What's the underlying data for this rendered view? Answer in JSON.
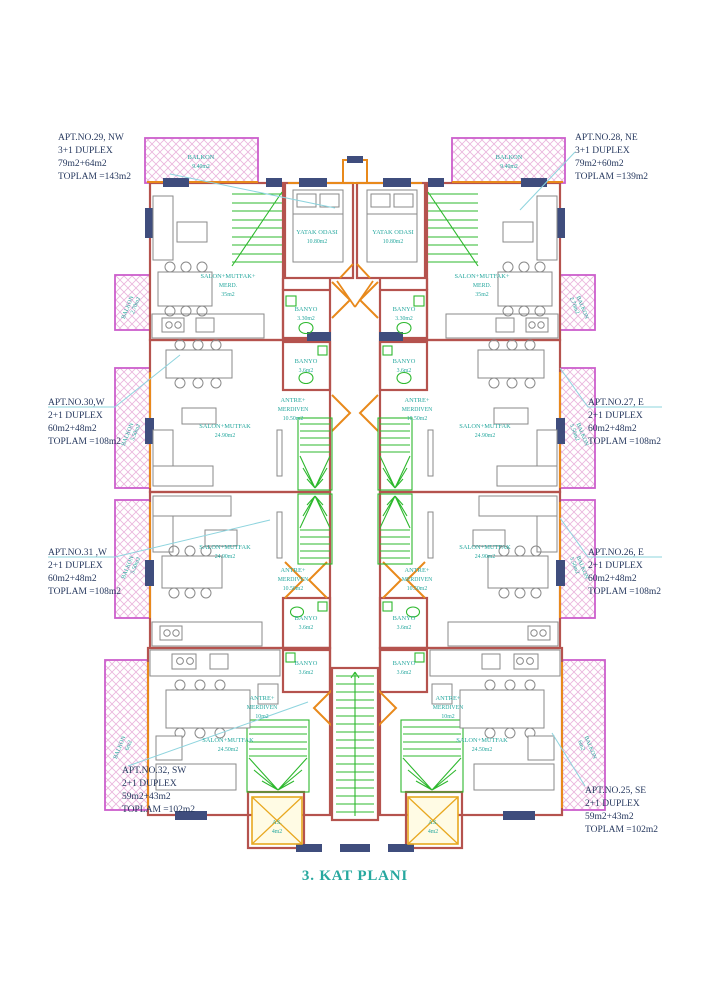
{
  "title": "3. KAT PLANI",
  "colors": {
    "wall": "#b5534e",
    "orange": "#e8891b",
    "navy": "#3f4d7d",
    "magenta": "#cc5ecc",
    "green": "#2db82d",
    "teal": "#27a89f",
    "callout_text": "#27395f",
    "leader": "#8ed4de",
    "elevator_yellow": "#e8a820",
    "furniture_gray": "#8a8a8a"
  },
  "apartments": [
    {
      "id": "apt29",
      "lines": [
        "APT.NO.29, NW",
        "3+1 DUPLEX",
        "79m2+64m2",
        "TOPLAM =143m2"
      ]
    },
    {
      "id": "apt28",
      "lines": [
        "APT.NO.28, NE",
        "3+1 DUPLEX",
        "79m2+60m2",
        "TOPLAM =139m2"
      ]
    },
    {
      "id": "apt30",
      "lines": [
        "APT.NO.30,W",
        "2+1 DUPLEX",
        "60m2+48m2",
        "TOPLAM =108m2"
      ]
    },
    {
      "id": "apt27",
      "lines": [
        "APT.NO.27, E",
        "2+1 DUPLEX",
        "60m2+48m2",
        "TOPLAM =108m2"
      ]
    },
    {
      "id": "apt31",
      "lines": [
        "APT.NO.31 ,W",
        "2+1 DUPLEX",
        "60m2+48m2",
        "TOPLAM =108m2"
      ]
    },
    {
      "id": "apt26",
      "lines": [
        "APT.NO.26, E",
        "2+1 DUPLEX",
        "60m2+48m2",
        "TOPLAM =108m2"
      ]
    },
    {
      "id": "apt32",
      "lines": [
        "APT.NO.32, SW",
        "2+1 DUPLEX",
        "59m2+43m2",
        "TOPLAM =102m2"
      ]
    },
    {
      "id": "apt25",
      "lines": [
        "APT.NO.25, SE",
        "2+1 DUPLEX",
        "59m2+43m2",
        "TOPLAM =102m2"
      ]
    }
  ],
  "rooms": {
    "yatak": {
      "name": "YATAK ODASI",
      "area": "10.80m2"
    },
    "salon_top": {
      "l1": "SALON+MUTFAK+",
      "l2": "MERD.",
      "l3": "35m2"
    },
    "balkon_top": {
      "name": "BALKON",
      "area": "9.40m2"
    },
    "balkon_small": {
      "name": "BALKON",
      "area": "2.70m2"
    },
    "balkon_mid": {
      "name": "BALKON",
      "area": "5.50m2"
    },
    "balkon_bot": {
      "name": "BALKON",
      "area": "6m2"
    },
    "banyo_a": {
      "name": "BANYO",
      "area": "3.30m2"
    },
    "banyo_b": {
      "name": "BANYO",
      "area": "3.6m2"
    },
    "antre_mid": {
      "l1": "ANTRE+",
      "l2": "MERDIVEN",
      "l3": "10.50m2"
    },
    "antre_bot": {
      "l1": "ANTRE+",
      "l2": "MERDIVEN",
      "l3": "10m2"
    },
    "salon_mid": {
      "name": "SALON+MUTFAK",
      "area": "24.90m2"
    },
    "salon_bot": {
      "name": "SALON+MUTFAK",
      "area": "24.50m2"
    },
    "asansor": {
      "name": "AS.",
      "area": "4m2"
    }
  }
}
